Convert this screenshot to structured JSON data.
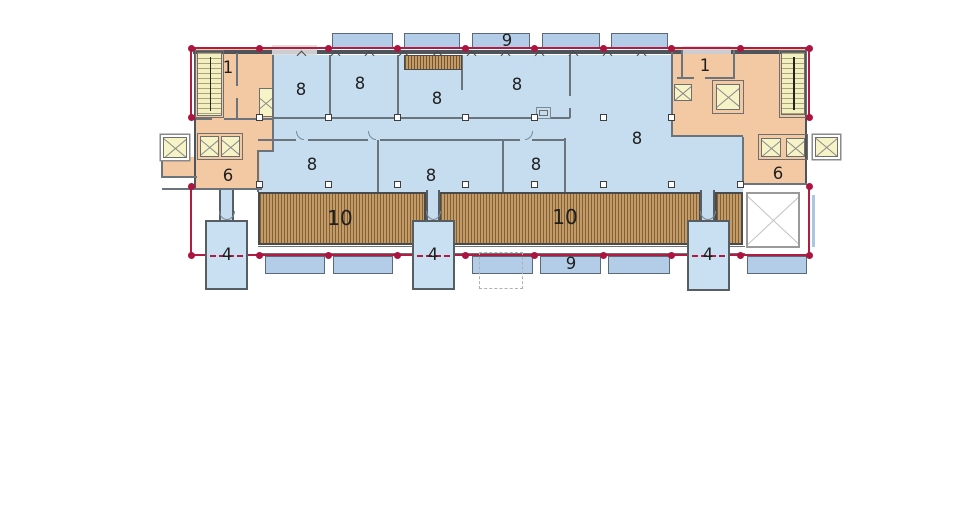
{
  "plan": {
    "labels": {
      "stairwell_left": "1",
      "stairwell_right": "1",
      "corridor_left": "6",
      "corridor_right": "6",
      "office_rooms": [
        "8",
        "8",
        "8",
        "8",
        "8",
        "8",
        "8",
        "8"
      ],
      "terrace_left": "10",
      "terrace_right": "10",
      "stair_towers": [
        "4",
        "4",
        "4"
      ],
      "balconies_top": "9",
      "balconies_bottom": "9"
    },
    "colors": {
      "room_fill": "#c6ddef",
      "corridor_fill": "#f3c9a3",
      "terrace_fill": "#c49a66",
      "elevator_fill": "#f6f3c6",
      "balcony_fill": "#b3cce8",
      "tower_fill": "#c9e0f2",
      "boundary_line": "#b11c42"
    }
  }
}
